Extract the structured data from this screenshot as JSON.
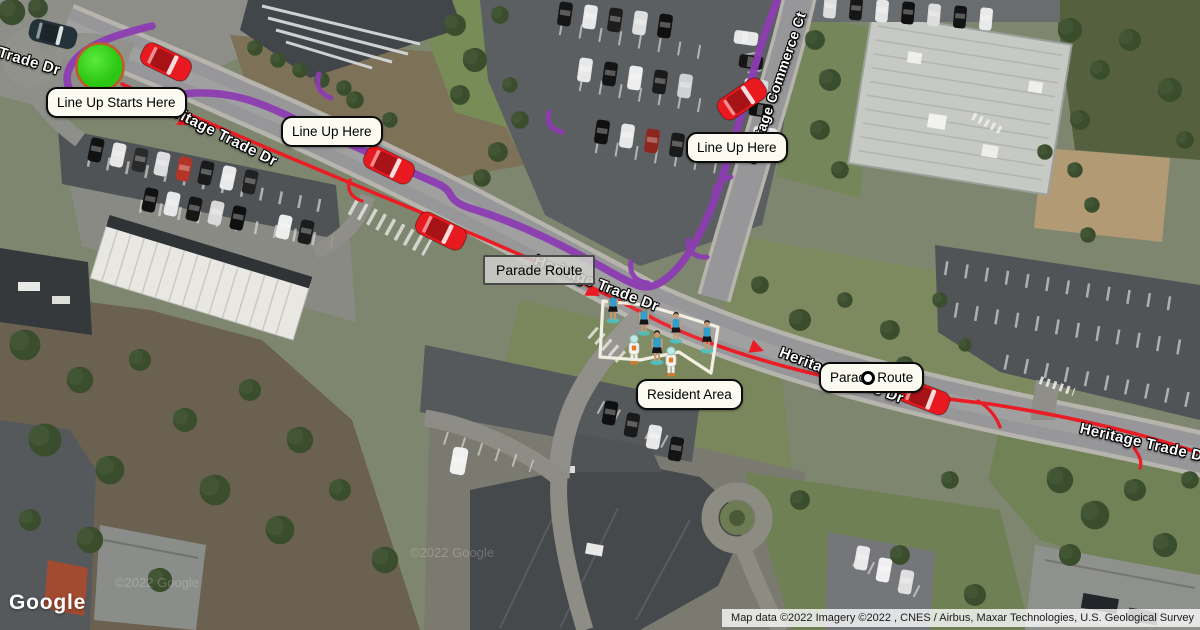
{
  "annotations": {
    "line_up_starts": "Line Up Starts Here",
    "line_up_here_west": "Line Up Here",
    "line_up_here_north": "Line Up Here",
    "parade_route_mid": "Parade Route",
    "parade_route_east": "Parade Route",
    "resident_area": "Resident Area"
  },
  "street_labels": {
    "trade_dr": "Trade Dr",
    "heritage_trade_dr_nw": "Heritage Trade Dr",
    "heritage_trade_dr_mid": "Heritage Trade Dr",
    "heritage_trade_dr_east": "Heritage Trade Dr",
    "heritage_trade_dr_se": "Heritage Trade Dr",
    "heritage_commerce_ct": "Heritage Commerce Ct"
  },
  "footer": {
    "logo": "Google",
    "attribution": "Map data ©2022 Imagery ©2022 , CNES / Airbus, Maxar Technologies, U.S. Geological Survey",
    "watermark": "©2022 Google"
  },
  "colors": {
    "lineup_route": "#8d3cb2",
    "parade_route": "#ea1c24",
    "parade_car": "#e8191f",
    "start_marker_fill": "#3ddc26",
    "start_marker_border": "#bf5b27"
  }
}
